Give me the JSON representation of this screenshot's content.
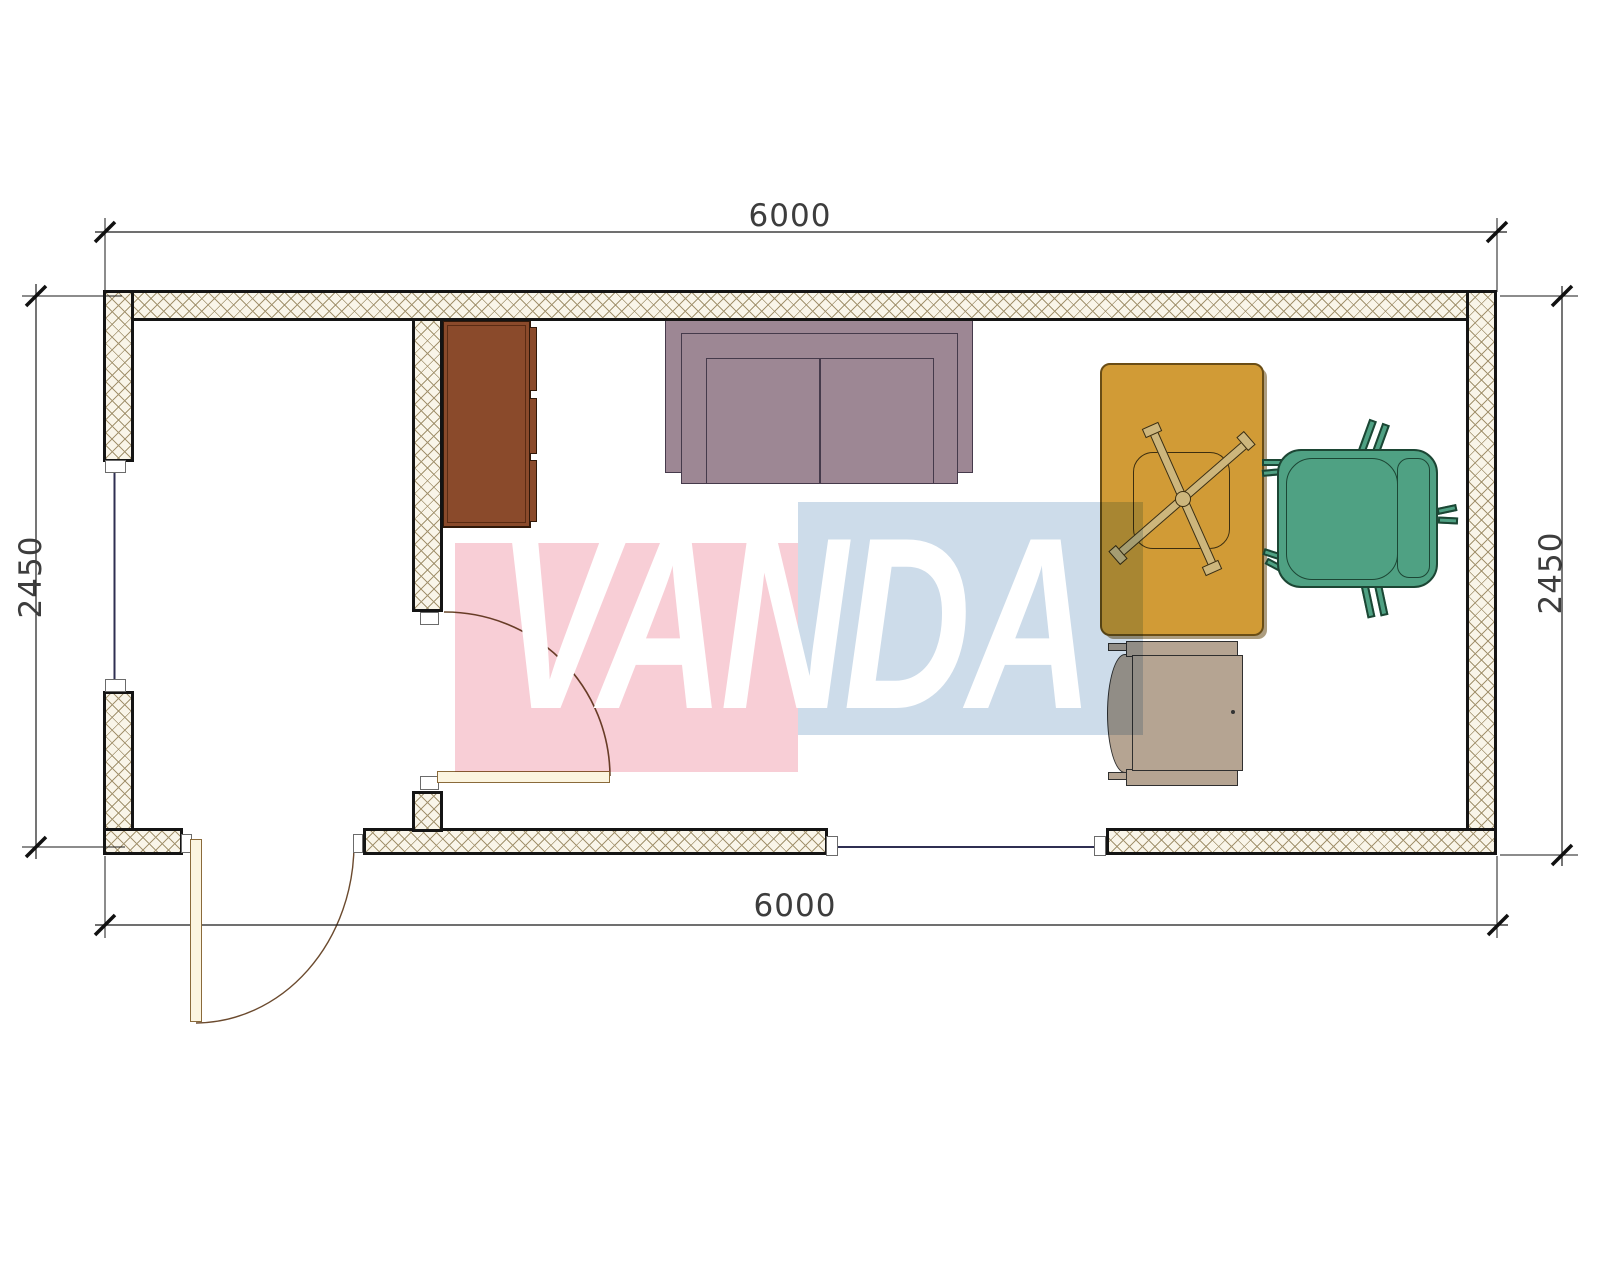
{
  "watermark": {
    "text": "VANDA",
    "pink_color": "#f8ced6",
    "blue_color": "#cddcea",
    "text_color": "#ffffff"
  },
  "dimensions": {
    "top": "6000",
    "bottom": "6000",
    "left": "2450",
    "right": "2450"
  },
  "colors": {
    "wall_hatch_bg": "#f9f5e9",
    "wall_hatch_line": "#a3936f",
    "wall_outline": "#141414",
    "sofa": "#9d8794",
    "cabinet": "#8a4a2b",
    "desk": "#d19b36",
    "desk_chair_base": "#cdb67c",
    "office_chair": "#4fa183",
    "side_chair": "#b5a492",
    "door_leaf": "#fcf5e0",
    "door_arc": "#6b4a2e",
    "window_line": "#2f2f52",
    "dimension_text": "#3d3d3d"
  }
}
